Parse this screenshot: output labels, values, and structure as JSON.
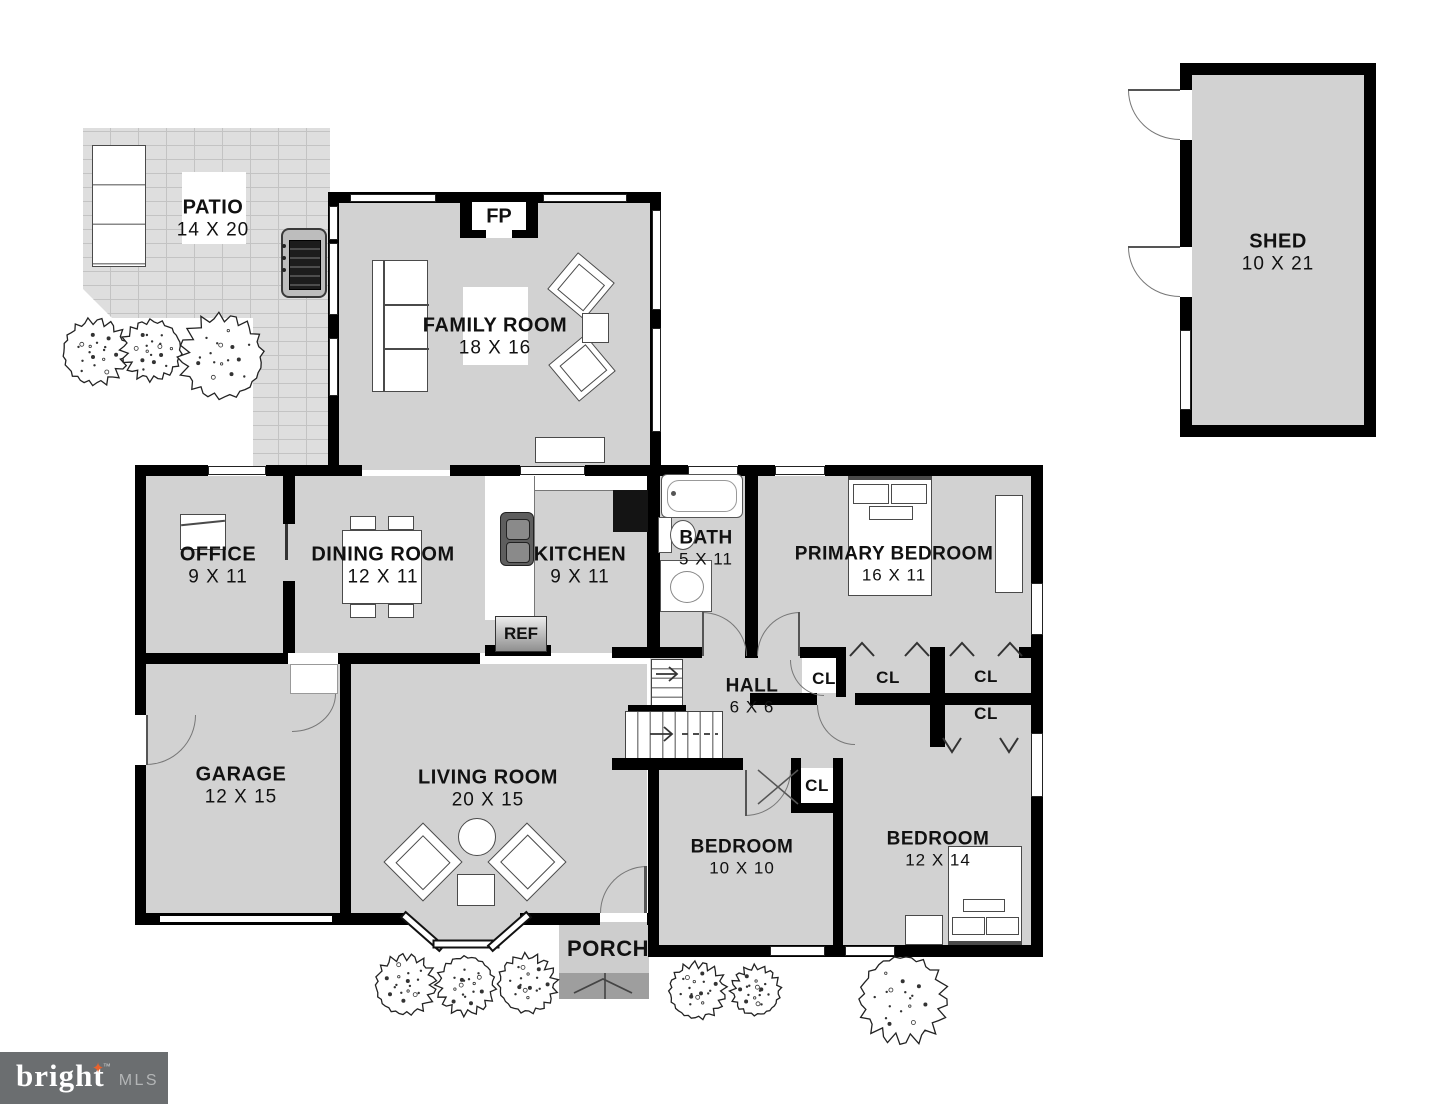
{
  "rooms": {
    "patio": {
      "name": "PATIO",
      "dims": "14 X 20"
    },
    "family": {
      "name": "FAMILY ROOM",
      "dims": "18 X 16"
    },
    "shed": {
      "name": "SHED",
      "dims": "10 X 21"
    },
    "office": {
      "name": "OFFICE",
      "dims": "9 X 11"
    },
    "dining": {
      "name": "DINING ROOM",
      "dims": "12 X 11"
    },
    "kitchen": {
      "name": "KITCHEN",
      "dims": "9 X 11"
    },
    "bath": {
      "name": "BATH",
      "dims": "5 X 11"
    },
    "primary": {
      "name": "PRIMARY BEDROOM",
      "dims": "16 X 11"
    },
    "hall": {
      "name": "HALL",
      "dims": "6 X 6"
    },
    "garage": {
      "name": "GARAGE",
      "dims": "12 X 15"
    },
    "living": {
      "name": "LIVING ROOM",
      "dims": "20 X 15"
    },
    "bed1": {
      "name": "BEDROOM",
      "dims": "10 X 10"
    },
    "bed2": {
      "name": "BEDROOM",
      "dims": "12 X 14"
    },
    "porch": {
      "name": "PORCH"
    }
  },
  "fixtures": {
    "fireplace_label": "FP",
    "fridge_label": "REF",
    "closet_label": "CL"
  },
  "logo": {
    "brand": "bright",
    "star": "✦",
    "tm": "™",
    "suffix": "MLS"
  },
  "colors": {
    "floor": "#d2d2d2",
    "wall": "#000000",
    "patio": "#dedede",
    "porch": "#cdcdcd",
    "steps": "#9e9e9e",
    "logo_bg": "#6b6e70",
    "logo_accent": "#e8622d"
  },
  "landscape": {
    "shrubs": [
      {
        "cx": 95,
        "cy": 352,
        "r": 36
      },
      {
        "cx": 152,
        "cy": 350,
        "r": 33
      },
      {
        "cx": 222,
        "cy": 357,
        "r": 46
      },
      {
        "cx": 405,
        "cy": 985,
        "r": 33
      },
      {
        "cx": 466,
        "cy": 985,
        "r": 32
      },
      {
        "cx": 527,
        "cy": 984,
        "r": 32
      },
      {
        "cx": 697,
        "cy": 991,
        "r": 31
      },
      {
        "cx": 756,
        "cy": 991,
        "r": 27
      },
      {
        "cx": 903,
        "cy": 999,
        "r": 48
      }
    ]
  }
}
